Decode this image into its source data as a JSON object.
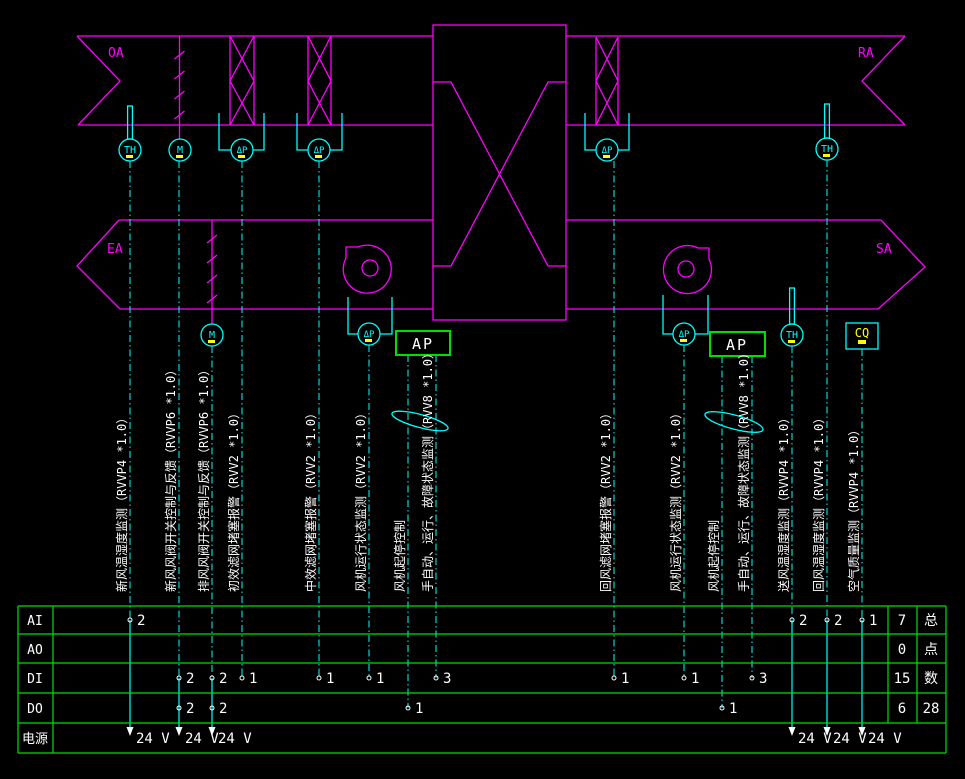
{
  "title": "空调机组监控原理图",
  "colors": {
    "background": "#000000",
    "duct": "#ff00ff",
    "sensor": "#00ffff",
    "table_grid": "#00e000",
    "text": "#ffffff",
    "tag": "#ffff00"
  },
  "duct_labels": {
    "oa": "OA",
    "ra": "RA",
    "ea": "EA",
    "sa": "SA"
  },
  "sensors": {
    "th": "TH",
    "m": "M",
    "dp": "ΔP",
    "cq": "CQ"
  },
  "controller": {
    "ap": "AP"
  },
  "signal_lines": [
    {
      "label": "新风温湿度监测（RVVP4 *1.0）"
    },
    {
      "label": "新风风阀开关控制与反馈（RVVP6 *1.0）"
    },
    {
      "label": "排风风阀开关控制与反馈（RVVP6 *1.0）"
    },
    {
      "label": "初效滤网堵塞报警（RVV2 *1.0）"
    },
    {
      "label": "中效滤网堵塞报警（RVV2 *1.0）"
    },
    {
      "label": "风机运行状态监测（RVV2 *1.0）"
    },
    {
      "label": "风机起停控制"
    },
    {
      "label": "手自动、运行、故障状态监测（RVV8 *1.0）"
    },
    {
      "label": "回风滤网堵塞报警（RVV2 *1.0）"
    },
    {
      "label": "风机运行状态监测（RVV2 *1.0）"
    },
    {
      "label": "风机起停控制"
    },
    {
      "label": "手自动、运行、故障状态监测（RVV8 *1.0）"
    },
    {
      "label": "送风温湿度监测（RVVP4 *1.0）"
    },
    {
      "label": "回风温湿度监测（RVVP4 *1.0）"
    },
    {
      "label": "空气质量监测（RVVP4 *1.0）"
    }
  ],
  "table": {
    "row_labels": [
      "AI",
      "AO",
      "DI",
      "DO",
      "电源"
    ],
    "ai_counts": [
      "2",
      "2",
      "2",
      "1"
    ],
    "di_counts": [
      "2",
      "2",
      "1",
      "1",
      "1",
      "3",
      "1",
      "1",
      "3"
    ],
    "do_counts": [
      "2",
      "2",
      "1",
      "1"
    ],
    "sums": [
      "7",
      "0",
      "15",
      "6"
    ],
    "total": "28",
    "total_header_chars": [
      "总",
      "点",
      "数"
    ],
    "power_label": "24 V"
  }
}
